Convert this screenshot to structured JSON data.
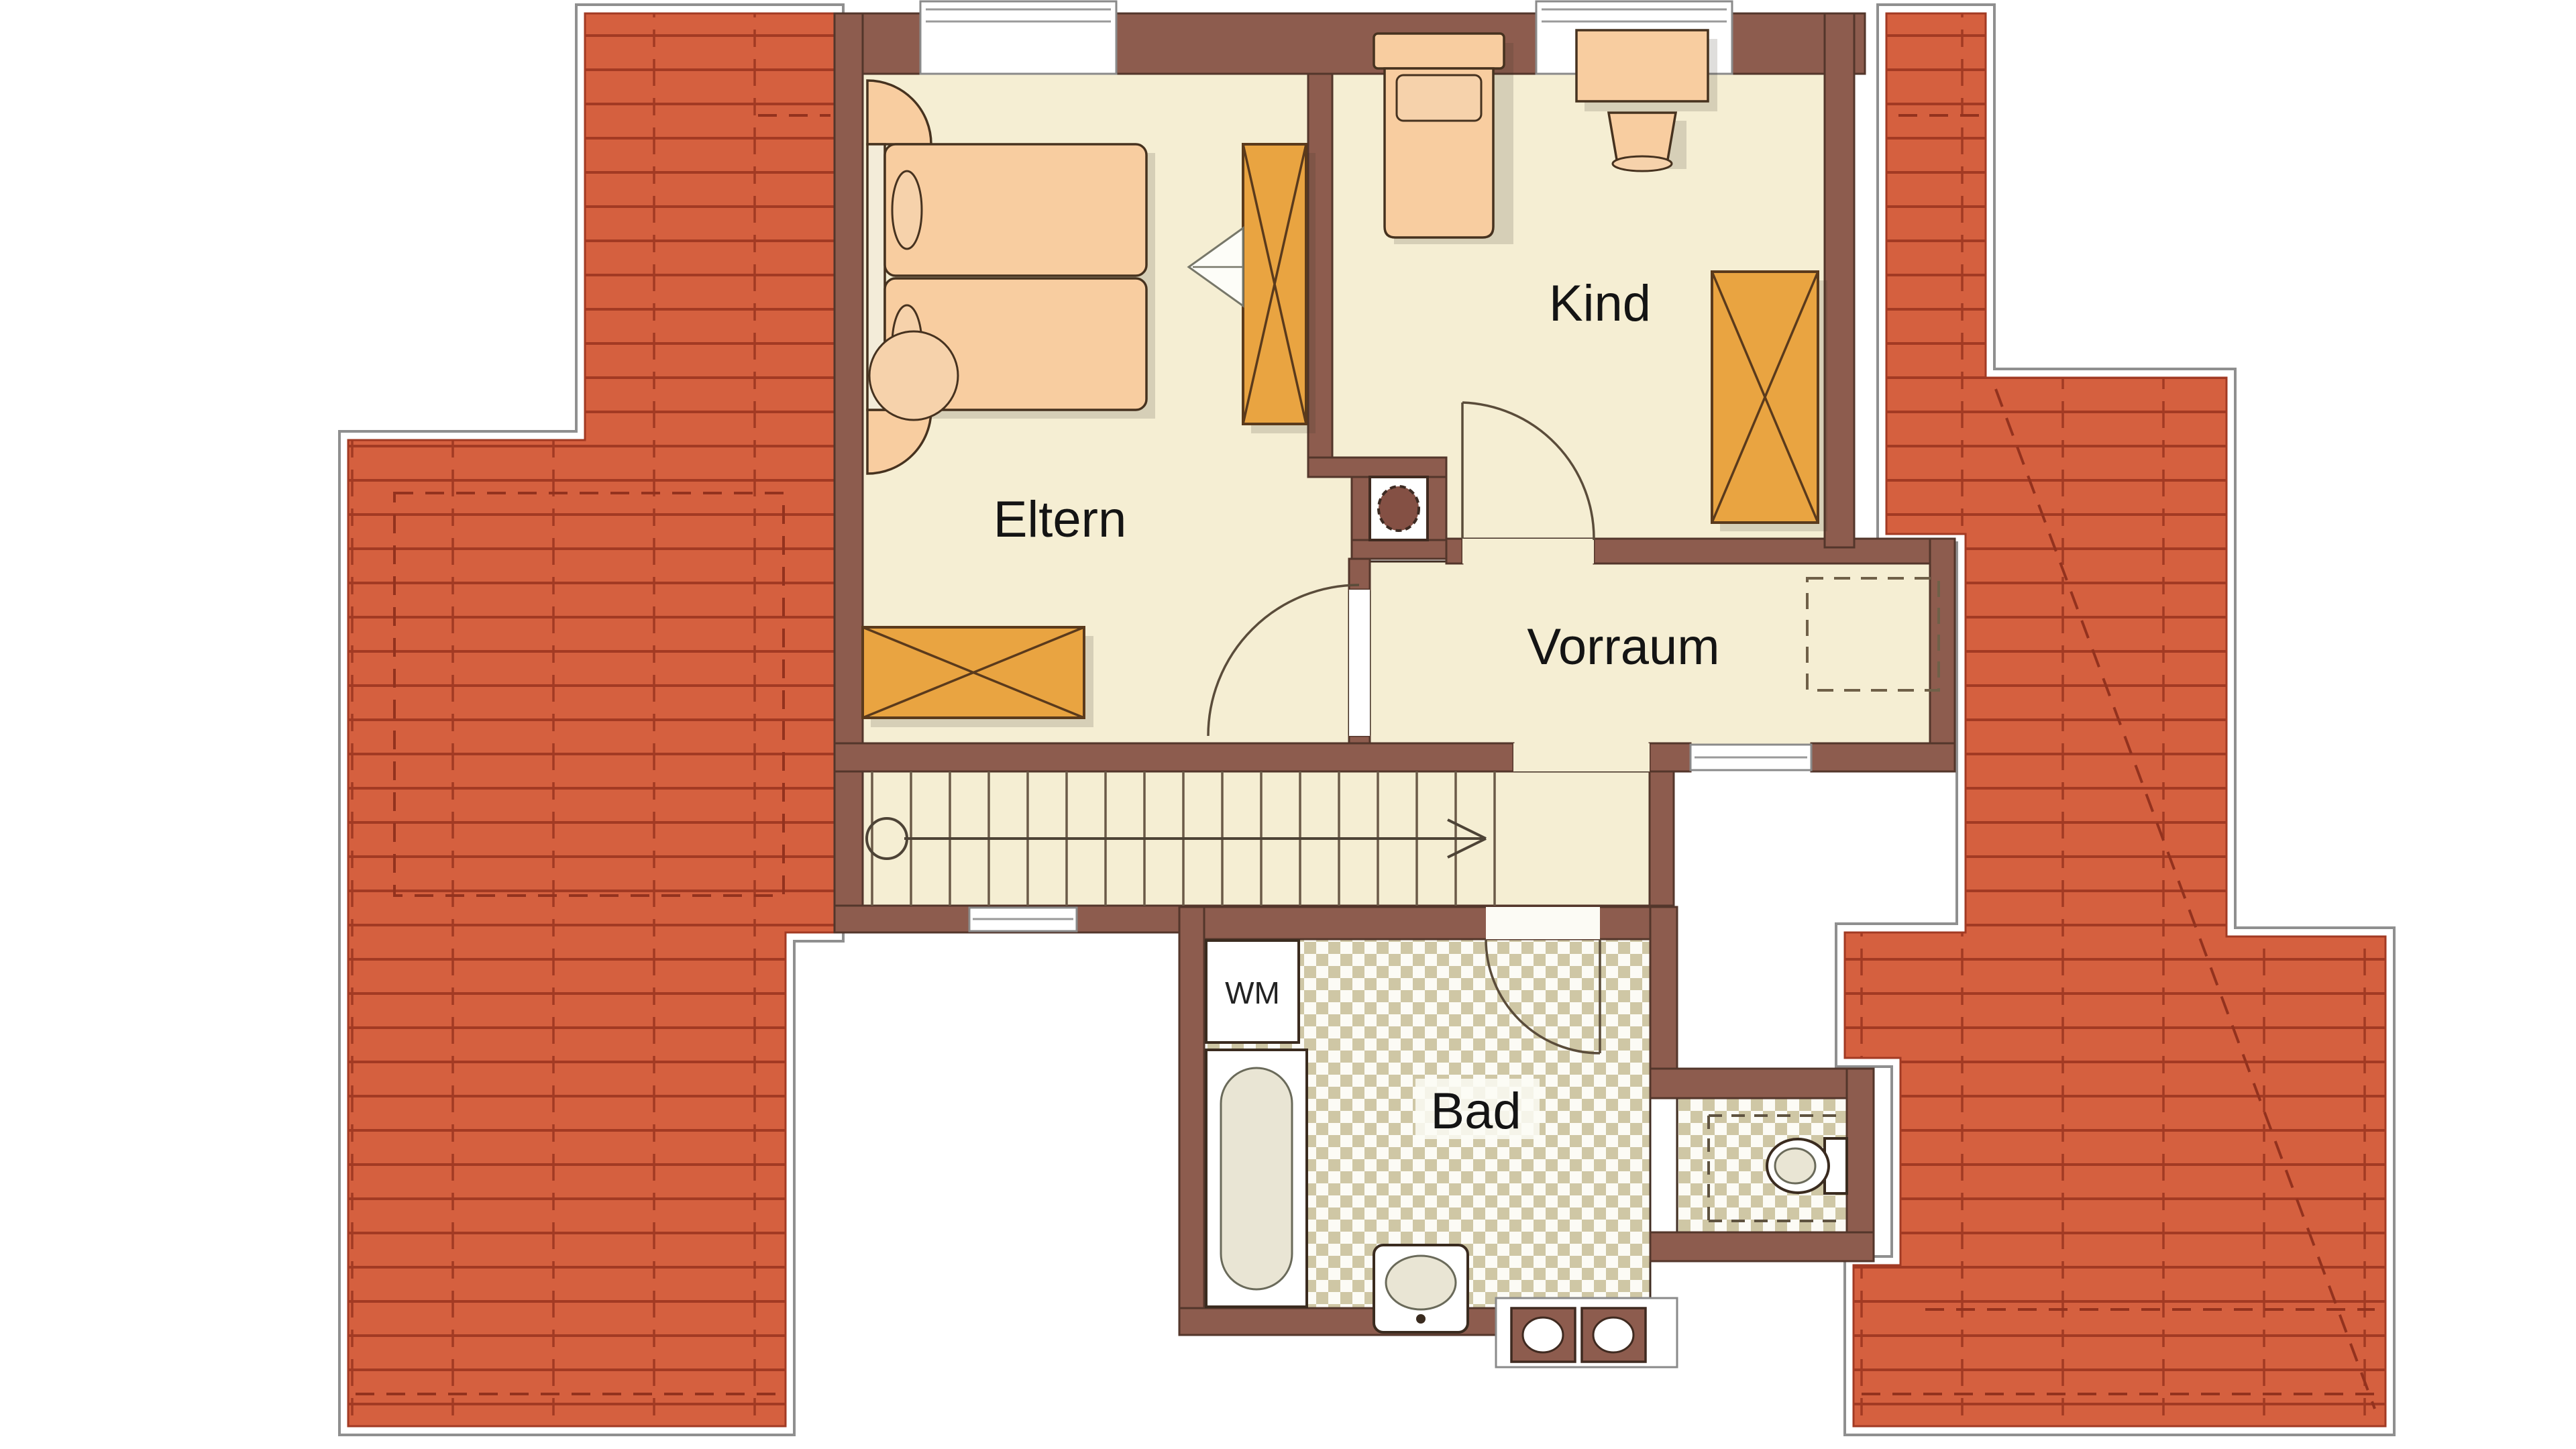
{
  "floorplan": {
    "type": "attic-floor architectural plan",
    "rooms": [
      {
        "id": "eltern",
        "label": "Eltern"
      },
      {
        "id": "kind",
        "label": "Kind"
      },
      {
        "id": "vorraum",
        "label": "Vorraum"
      },
      {
        "id": "bad",
        "label": "Bad"
      }
    ],
    "appliances": {
      "washing_machine_label": "WM"
    },
    "fixtures": [
      "bathtub",
      "washbasin",
      "toilet",
      "double-basin-window",
      "chimney"
    ],
    "stairs": {
      "step_count": 16,
      "direction": "up to the right"
    },
    "windows": {
      "top_wall": 2,
      "stair_hall_bottom_wall": 1,
      "vorraum_bottom_opening": 1
    },
    "colors": {
      "background": "#ffffff",
      "roof_fill": "#d5603f",
      "roof_line": "#a23a23",
      "roof_dash": "#93321e",
      "outline_gray": "#8f8f8f",
      "wall_fill": "#8d5c4e",
      "wall_edge": "#53362b",
      "floor_cream": "#f5eed3",
      "bath_floor": "#fcfbf5",
      "tile_checker": "#cfc7a5",
      "furniture_peach": "#f8cda0",
      "wardrobe_orange": "#e9a441",
      "fixture_white": "#ffffff",
      "text": "#141414"
    }
  }
}
